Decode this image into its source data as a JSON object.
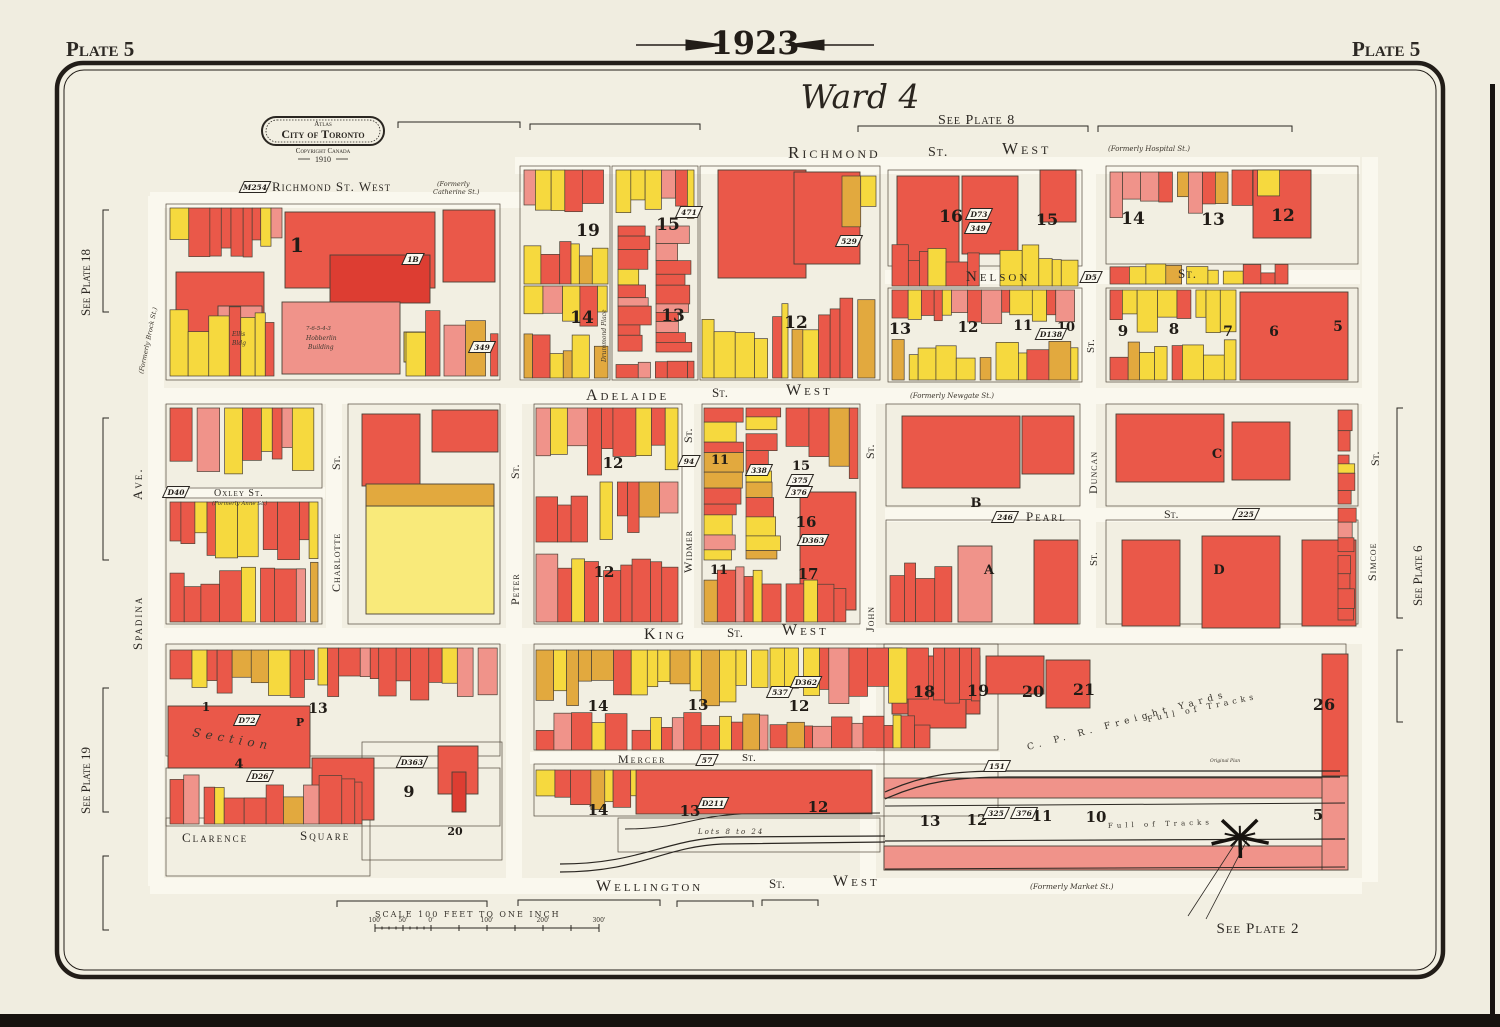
{
  "title": {
    "plate_left": "Plate 5",
    "plate_right": "Plate 5",
    "year": "1923",
    "ward": "Ward 4"
  },
  "logo": {
    "atlas": "Atlas",
    "city": "City of Toronto",
    "copyright": "Copyright Canada",
    "year": "1910"
  },
  "scale_bar": {
    "label": "SCALE 100 FEET TO ONE INCH",
    "ticks": [
      "100'",
      "50'",
      "0'",
      "100'",
      "200'",
      "300'"
    ]
  },
  "colors": {
    "paper": "#f2efe2",
    "street": "#faf8ee",
    "ink": "#2b2722",
    "outline": "#4a4136",
    "red": "#ea5849",
    "red_light": "#f0938a",
    "red_dark": "#dd3d32",
    "pink": "#f3a89e",
    "yellow": "#f6d93e",
    "yellow_pale": "#f9ea7a",
    "orange": "#e2a93e"
  },
  "plate_refs": [
    {
      "t": "See Plate 8",
      "x": 938,
      "y": 124,
      "fs": 14,
      "ls": 1
    },
    {
      "t": "See Plate 2",
      "x": 1258,
      "y": 933,
      "fs": 15,
      "ls": 1,
      "a": "middle"
    },
    {
      "t": "See Plate 18",
      "x": 90,
      "y": 316,
      "r": -90,
      "fs": 13
    },
    {
      "t": "See Plate 19",
      "x": 90,
      "y": 814,
      "r": -90,
      "fs": 13
    },
    {
      "t": "See Plate 6",
      "x": 1422,
      "y": 606,
      "r": -90,
      "fs": 13
    }
  ],
  "streets": [
    {
      "t": "Richmond St. West",
      "x": 272,
      "y": 191,
      "fs": 13,
      "ls": 1
    },
    {
      "t": "(Formerly",
      "x": 437,
      "y": 186,
      "fs": 6.5,
      "cls": "it"
    },
    {
      "t": "Catherine St.)",
      "x": 433,
      "y": 194,
      "fs": 6.5,
      "cls": "it"
    },
    {
      "t": "Richmond",
      "x": 788,
      "y": 158,
      "fs": 17,
      "ls": 3
    },
    {
      "t": "St.",
      "x": 928,
      "y": 156,
      "fs": 14,
      "ls": 1
    },
    {
      "t": "West",
      "x": 1002,
      "y": 154,
      "fs": 17,
      "ls": 3
    },
    {
      "t": "(Formerly Hospital St.)",
      "x": 1108,
      "y": 151,
      "fs": 7,
      "cls": "it"
    },
    {
      "t": "Nelson",
      "x": 966,
      "y": 281,
      "fs": 15,
      "ls": 3
    },
    {
      "t": "St.",
      "x": 1178,
      "y": 278,
      "fs": 13,
      "ls": 1
    },
    {
      "t": "Adelaide",
      "x": 586,
      "y": 400,
      "fs": 16,
      "ls": 3
    },
    {
      "t": "St.",
      "x": 712,
      "y": 397,
      "fs": 13
    },
    {
      "t": "West",
      "x": 786,
      "y": 395,
      "fs": 16,
      "ls": 3
    },
    {
      "t": "(Formerly Newgate St.)",
      "x": 910,
      "y": 398,
      "fs": 7,
      "cls": "it"
    },
    {
      "t": "Oxley St.",
      "x": 214,
      "y": 496,
      "fs": 10,
      "ls": 1
    },
    {
      "t": "(Formerly Anne St.)",
      "x": 212,
      "y": 505,
      "fs": 5.5,
      "cls": "it"
    },
    {
      "t": "Pearl",
      "x": 1026,
      "y": 521,
      "fs": 13,
      "ls": 2
    },
    {
      "t": "St.",
      "x": 1164,
      "y": 518,
      "fs": 12
    },
    {
      "t": "King",
      "x": 644,
      "y": 639,
      "fs": 16,
      "ls": 3
    },
    {
      "t": "St.",
      "x": 727,
      "y": 637,
      "fs": 13
    },
    {
      "t": "West",
      "x": 782,
      "y": 635,
      "fs": 16,
      "ls": 3
    },
    {
      "t": "Mercer",
      "x": 618,
      "y": 763,
      "fs": 12,
      "ls": 2
    },
    {
      "t": "St.",
      "x": 742,
      "y": 761,
      "fs": 11
    },
    {
      "t": "Wellington",
      "x": 596,
      "y": 891,
      "fs": 16,
      "ls": 3
    },
    {
      "t": "St.",
      "x": 769,
      "y": 888,
      "fs": 13
    },
    {
      "t": "West",
      "x": 833,
      "y": 886,
      "fs": 16,
      "ls": 3
    },
    {
      "t": "(Formerly Market St.)",
      "x": 1030,
      "y": 889,
      "fs": 7.5,
      "cls": "it"
    },
    {
      "t": "Clarence",
      "x": 182,
      "y": 842,
      "fs": 13,
      "ls": 2
    },
    {
      "t": "Square",
      "x": 300,
      "y": 840,
      "fs": 13,
      "ls": 2
    },
    {
      "t": "Ave.",
      "x": 142,
      "y": 500,
      "r": -90,
      "fs": 13,
      "ls": 2
    },
    {
      "t": "Spadina",
      "x": 142,
      "y": 650,
      "r": -90,
      "fs": 13,
      "ls": 2
    },
    {
      "t": "(Formerly Brock St.)",
      "x": 143,
      "y": 374,
      "r": -78,
      "fs": 6.5,
      "cls": "it"
    },
    {
      "t": "St.",
      "x": 340,
      "y": 470,
      "r": -90,
      "fs": 12
    },
    {
      "t": "Charlotte",
      "x": 340,
      "y": 592,
      "r": -90,
      "fs": 12,
      "ls": 1
    },
    {
      "t": "St.",
      "x": 519,
      "y": 479,
      "r": -90,
      "fs": 12
    },
    {
      "t": "Peter",
      "x": 519,
      "y": 605,
      "r": -90,
      "fs": 12,
      "ls": 1
    },
    {
      "t": "St.",
      "x": 692,
      "y": 443,
      "r": -90,
      "fs": 12
    },
    {
      "t": "Widmer",
      "x": 692,
      "y": 573,
      "r": -90,
      "fs": 12,
      "ls": 1
    },
    {
      "t": "St.",
      "x": 874,
      "y": 459,
      "r": -90,
      "fs": 12
    },
    {
      "t": "John",
      "x": 874,
      "y": 632,
      "r": -90,
      "fs": 12,
      "ls": 1
    },
    {
      "t": "St.",
      "x": 1094,
      "y": 353,
      "r": -90,
      "fs": 11
    },
    {
      "t": "Duncan",
      "x": 1097,
      "y": 494,
      "r": -90,
      "fs": 12,
      "ls": 1
    },
    {
      "t": "St.",
      "x": 1097,
      "y": 566,
      "r": -90,
      "fs": 11
    },
    {
      "t": "St.",
      "x": 1379,
      "y": 466,
      "r": -90,
      "fs": 12
    },
    {
      "t": "Simcoe",
      "x": 1376,
      "y": 581,
      "r": -90,
      "fs": 12,
      "ls": 1
    },
    {
      "t": "Drummond Place",
      "x": 606,
      "y": 362,
      "r": -90,
      "fs": 6,
      "cls": "it"
    }
  ],
  "block_numbers": [
    {
      "t": "1",
      "x": 297,
      "y": 252,
      "fs": 20
    },
    {
      "t": "19",
      "x": 588,
      "y": 236,
      "fs": 17
    },
    {
      "t": "15",
      "x": 668,
      "y": 230,
      "fs": 17
    },
    {
      "t": "14",
      "x": 582,
      "y": 323,
      "fs": 17
    },
    {
      "t": "13",
      "x": 673,
      "y": 321,
      "fs": 17
    },
    {
      "t": "12",
      "x": 796,
      "y": 328,
      "fs": 17
    },
    {
      "t": "16",
      "x": 951,
      "y": 222,
      "fs": 17
    },
    {
      "t": "15",
      "x": 1047,
      "y": 225,
      "fs": 16
    },
    {
      "t": "14",
      "x": 1133,
      "y": 224,
      "fs": 17
    },
    {
      "t": "13",
      "x": 1213,
      "y": 225,
      "fs": 17
    },
    {
      "t": "12",
      "x": 1283,
      "y": 221,
      "fs": 17
    },
    {
      "t": "13",
      "x": 900,
      "y": 334,
      "fs": 16
    },
    {
      "t": "12",
      "x": 968,
      "y": 332,
      "fs": 15
    },
    {
      "t": "11",
      "x": 1023,
      "y": 330,
      "fs": 14
    },
    {
      "t": "10",
      "x": 1066,
      "y": 331,
      "fs": 13
    },
    {
      "t": "9",
      "x": 1123,
      "y": 336,
      "fs": 15
    },
    {
      "t": "8",
      "x": 1174,
      "y": 334,
      "fs": 15
    },
    {
      "t": "7",
      "x": 1228,
      "y": 336,
      "fs": 14
    },
    {
      "t": "6",
      "x": 1274,
      "y": 336,
      "fs": 14
    },
    {
      "t": "5",
      "x": 1338,
      "y": 331,
      "fs": 14
    },
    {
      "t": "12",
      "x": 613,
      "y": 468,
      "fs": 15
    },
    {
      "t": "11",
      "x": 720,
      "y": 464,
      "fs": 13
    },
    {
      "t": "15",
      "x": 801,
      "y": 470,
      "fs": 13
    },
    {
      "t": "16",
      "x": 806,
      "y": 527,
      "fs": 15
    },
    {
      "t": "B",
      "x": 976,
      "y": 507,
      "fs": 13
    },
    {
      "t": "C",
      "x": 1217,
      "y": 458,
      "fs": 13
    },
    {
      "t": "12",
      "x": 604,
      "y": 577,
      "fs": 15
    },
    {
      "t": "11",
      "x": 719,
      "y": 574,
      "fs": 13
    },
    {
      "t": "17",
      "x": 808,
      "y": 579,
      "fs": 15
    },
    {
      "t": "A",
      "x": 989,
      "y": 574,
      "fs": 13
    },
    {
      "t": "D",
      "x": 1219,
      "y": 574,
      "fs": 13
    },
    {
      "t": "1",
      "x": 206,
      "y": 711,
      "fs": 12
    },
    {
      "t": "13",
      "x": 318,
      "y": 713,
      "fs": 14
    },
    {
      "t": "P",
      "x": 300,
      "y": 726,
      "fs": 11
    },
    {
      "t": "4",
      "x": 239,
      "y": 768,
      "fs": 13
    },
    {
      "t": "9",
      "x": 409,
      "y": 797,
      "fs": 16
    },
    {
      "t": "20",
      "x": 455,
      "y": 835,
      "fs": 11
    },
    {
      "t": "14",
      "x": 598,
      "y": 711,
      "fs": 15
    },
    {
      "t": "13",
      "x": 698,
      "y": 710,
      "fs": 15
    },
    {
      "t": "12",
      "x": 799,
      "y": 711,
      "fs": 15
    },
    {
      "t": "14",
      "x": 598,
      "y": 815,
      "fs": 15
    },
    {
      "t": "13",
      "x": 690,
      "y": 816,
      "fs": 15
    },
    {
      "t": "12",
      "x": 818,
      "y": 812,
      "fs": 15
    },
    {
      "t": "18",
      "x": 924,
      "y": 697,
      "fs": 16
    },
    {
      "t": "19",
      "x": 978,
      "y": 696,
      "fs": 16
    },
    {
      "t": "20",
      "x": 1033,
      "y": 697,
      "fs": 16
    },
    {
      "t": "21",
      "x": 1084,
      "y": 695,
      "fs": 16
    },
    {
      "t": "26",
      "x": 1324,
      "y": 710,
      "fs": 16
    },
    {
      "t": "13",
      "x": 930,
      "y": 826,
      "fs": 15
    },
    {
      "t": "12",
      "x": 977,
      "y": 825,
      "fs": 15
    },
    {
      "t": "11",
      "x": 1042,
      "y": 821,
      "fs": 15
    },
    {
      "t": "10",
      "x": 1096,
      "y": 822,
      "fs": 15
    },
    {
      "t": "5",
      "x": 1318,
      "y": 820,
      "fs": 15
    }
  ],
  "plate_markers": [
    {
      "t": "M254",
      "x": 255,
      "y": 187
    },
    {
      "t": "1B",
      "x": 413,
      "y": 259
    },
    {
      "t": "349",
      "x": 482,
      "y": 347
    },
    {
      "t": "471",
      "x": 689,
      "y": 212
    },
    {
      "t": "529",
      "x": 849,
      "y": 241
    },
    {
      "t": "D73",
      "x": 979,
      "y": 214
    },
    {
      "t": "349",
      "x": 978,
      "y": 228
    },
    {
      "t": "D5",
      "x": 1091,
      "y": 277
    },
    {
      "t": "D40",
      "x": 176,
      "y": 492
    },
    {
      "t": "246",
      "x": 1005,
      "y": 517
    },
    {
      "t": "225",
      "x": 1246,
      "y": 514
    },
    {
      "t": "94",
      "x": 689,
      "y": 461
    },
    {
      "t": "338",
      "x": 759,
      "y": 470
    },
    {
      "t": "375",
      "x": 800,
      "y": 480
    },
    {
      "t": "376",
      "x": 799,
      "y": 492
    },
    {
      "t": "D363",
      "x": 813,
      "y": 540
    },
    {
      "t": "537",
      "x": 780,
      "y": 692
    },
    {
      "t": "D362",
      "x": 806,
      "y": 682
    },
    {
      "t": "D72",
      "x": 247,
      "y": 720
    },
    {
      "t": "D26",
      "x": 260,
      "y": 776
    },
    {
      "t": "D363",
      "x": 412,
      "y": 762
    },
    {
      "t": "57",
      "x": 707,
      "y": 760
    },
    {
      "t": "D211",
      "x": 713,
      "y": 803
    },
    {
      "t": "D138",
      "x": 1051,
      "y": 334
    },
    {
      "t": "151",
      "x": 997,
      "y": 766
    },
    {
      "t": "325",
      "x": 996,
      "y": 813
    },
    {
      "t": "376",
      "x": 1024,
      "y": 813
    }
  ],
  "annotations": [
    {
      "t": "C. P. R.  Freight  Yards",
      "x": 1028,
      "y": 750,
      "r": -15,
      "fs": 9,
      "ls": 5,
      "cls": "sp"
    },
    {
      "t": "Full  of  Tracks",
      "x": 1148,
      "y": 722,
      "r": -12,
      "fs": 8,
      "ls": 4,
      "cls": "sp"
    },
    {
      "t": "Full  of  Tracks",
      "x": 1108,
      "y": 828,
      "r": -2,
      "fs": 7,
      "ls": 4,
      "cls": "sp"
    },
    {
      "t": "Lots 8 to 24",
      "x": 698,
      "y": 834,
      "fs": 7,
      "ls": 2,
      "cls": "it"
    },
    {
      "t": "Section",
      "x": 192,
      "y": 736,
      "r": 10,
      "fs": 12,
      "ls": 5,
      "cls": "it"
    },
    {
      "t": "7-6-5-4-3",
      "x": 306,
      "y": 330,
      "fs": 5.5,
      "cls": "it"
    },
    {
      "t": "Hobberlin",
      "x": 306,
      "y": 340,
      "fs": 6,
      "cls": "it"
    },
    {
      "t": "Building",
      "x": 308,
      "y": 349,
      "fs": 6,
      "cls": "it"
    },
    {
      "t": "Ellis",
      "x": 232,
      "y": 336,
      "fs": 6,
      "cls": "it"
    },
    {
      "t": "Bldg",
      "x": 232,
      "y": 345,
      "fs": 6,
      "cls": "it"
    },
    {
      "t": "Original Plan",
      "x": 1210,
      "y": 762,
      "fs": 4.5,
      "cls": "it"
    }
  ]
}
